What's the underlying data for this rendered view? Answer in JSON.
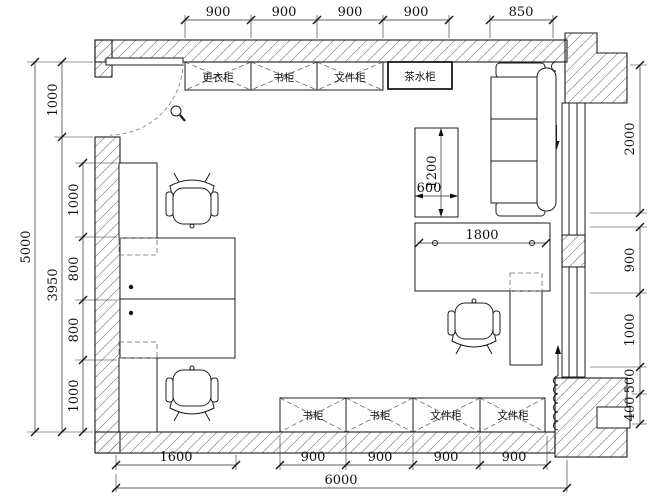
{
  "drawing": {
    "kind": "office floor plan",
    "units": "mm"
  },
  "cabinets": {
    "top": [
      {
        "label": "更衣柜"
      },
      {
        "label": "书柜"
      },
      {
        "label": "文件柜"
      },
      {
        "label": "茶水柜"
      }
    ],
    "bottom": [
      {
        "label": "书柜"
      },
      {
        "label": "书柜"
      },
      {
        "label": "文件柜"
      },
      {
        "label": "文件柜"
      }
    ]
  },
  "dims": {
    "top": [
      "900",
      "900",
      "900",
      "900"
    ],
    "top_right": "850",
    "left_total": "5000",
    "left_mid": [
      "1000",
      "3950"
    ],
    "left_inner": [
      "1000",
      "800",
      "800",
      "1000"
    ],
    "right_top": "2000",
    "right_lower": [
      "900",
      "1000",
      "500",
      "400"
    ],
    "bottom_inner": [
      "1600",
      "900",
      "900",
      "900",
      "900"
    ],
    "bottom_total": "6000",
    "interior": {
      "cabinet_width": "600",
      "cabinet_length": "1200",
      "desk_length": "1800"
    }
  },
  "colors": {
    "background": "#ffffff",
    "line": "#1c1c1c",
    "hatch": "#8a8a8a",
    "hidden": "#6a6a6a"
  }
}
